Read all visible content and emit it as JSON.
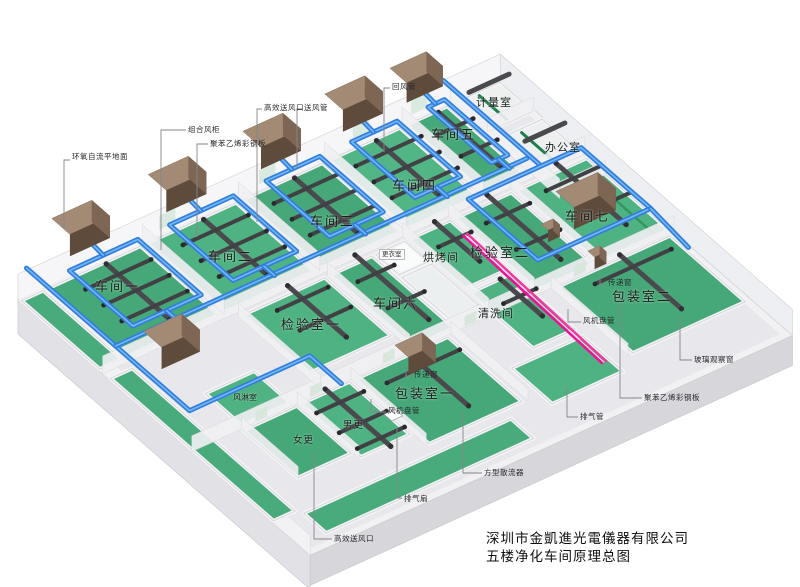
{
  "title_block": {
    "line1": "深圳市金凱進光電儀器有限公司",
    "line2": "五楼净化车间原理总图"
  },
  "rooms": {
    "workshop1": "车间一",
    "workshop2": "车间二",
    "workshop3": "车间三",
    "workshop4": "车间四",
    "workshop5": "车间五",
    "workshop6": "车间六",
    "workshop7": "车间七",
    "inspection1": "检验室一",
    "inspection2": "检验室二",
    "baking": "烘烤间",
    "cleaning": "清洗间",
    "packing1": "包装室一",
    "packing2": "包装室二",
    "metering": "计量室",
    "office": "办公室",
    "air_shower": "风淋室",
    "dressing": "更衣室",
    "men_change": "男更",
    "women_change": "女更"
  },
  "callouts": {
    "epoxy_floor": "环氧自流平地面",
    "combined_ahu": "组合风柜",
    "steel_panel_left": "聚苯乙烯彩钢板",
    "hepa_outlet_top": "高效送风口",
    "supply_duct": "送风管",
    "return_duct": "回风管",
    "transfer_window_1": "传递窗",
    "transfer_window_2": "传递窗",
    "fan_coil_1": "风机盘管",
    "fan_coil_2": "风机盘管",
    "exhaust_fan": "排气扇",
    "hepa_outlet_bottom": "高效送风口",
    "square_diffuser": "方型散流器",
    "exhaust_pipe": "排气管",
    "glass_window": "玻璃观察窗",
    "steel_panel_right": "聚苯乙烯彩钢板"
  },
  "colors": {
    "floor_green": "#46a878",
    "duct_blue": "#2e7fe0",
    "duct_dark": "#4a4a4e",
    "ahu_brown": "#63503f",
    "exhaust_pink": "#f00f9a"
  }
}
